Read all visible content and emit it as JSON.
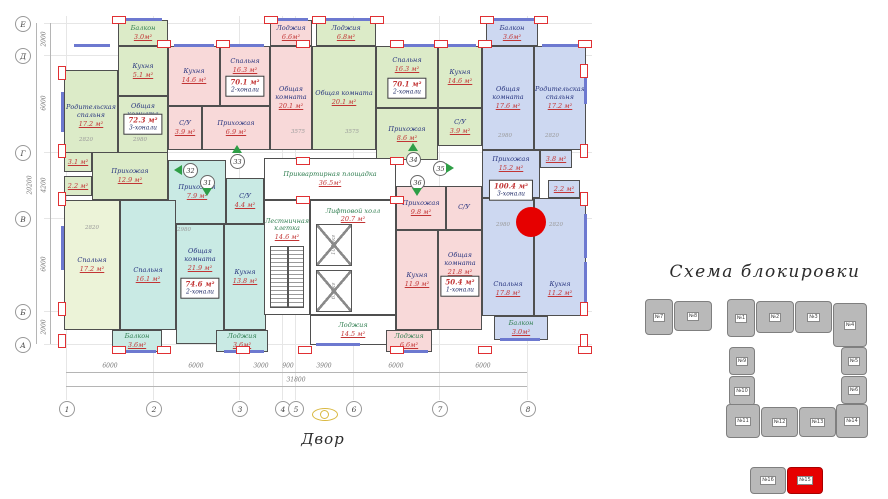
{
  "palette": {
    "green": "#dcebc8",
    "pale": "#ecf3d8",
    "pink": "#f8d9d9",
    "teal": "#c9eae4",
    "blue": "#cdd8f1",
    "white": "#ffffff"
  },
  "plan": {
    "rooms": [
      {
        "n": "Родительская спальня",
        "a": "17.2 м²",
        "x": 64,
        "y": 70,
        "w": 54,
        "h": 92,
        "c": "green"
      },
      {
        "n": "Балкон",
        "a": "3.0м²",
        "x": 118,
        "y": 20,
        "w": 50,
        "h": 26,
        "c": "green",
        "tc": "green"
      },
      {
        "n": "Кухня",
        "a": "5.1 м²",
        "x": 118,
        "y": 46,
        "w": 50,
        "h": 50,
        "c": "green"
      },
      {
        "n": "Общая комната",
        "a": "17.6 м²",
        "x": 118,
        "y": 96,
        "w": 50,
        "h": 66,
        "c": "green",
        "dy": -14
      },
      {
        "n": "",
        "a": "3.1 м²",
        "x": 64,
        "y": 152,
        "w": 28,
        "h": 20,
        "c": "green"
      },
      {
        "n": "Прихожая",
        "a": "12.9 м²",
        "x": 92,
        "y": 152,
        "w": 76,
        "h": 48,
        "c": "green"
      },
      {
        "n": "",
        "a": "2.2 м²",
        "x": 64,
        "y": 176,
        "w": 28,
        "h": 20,
        "c": "green"
      },
      {
        "n": "Спальня",
        "a": "17.2 м²",
        "x": 64,
        "y": 200,
        "w": 56,
        "h": 130,
        "c": "pale"
      },
      {
        "n": "Кухня",
        "a": "14.6 м²",
        "x": 168,
        "y": 46,
        "w": 52,
        "h": 60,
        "c": "pink"
      },
      {
        "n": "Спальня",
        "a": "16.3 м²",
        "x": 220,
        "y": 46,
        "w": 50,
        "h": 60,
        "c": "pink",
        "dy": -10
      },
      {
        "n": "Общая комната",
        "a": "20.1 м²",
        "x": 270,
        "y": 46,
        "w": 42,
        "h": 104,
        "c": "pink"
      },
      {
        "n": "Лоджия",
        "a": "6.6м²",
        "x": 270,
        "y": 20,
        "w": 42,
        "h": 26,
        "c": "pink"
      },
      {
        "n": "С/У",
        "a": "3.9 м²",
        "x": 168,
        "y": 106,
        "w": 34,
        "h": 44,
        "c": "pink"
      },
      {
        "n": "Прихожая",
        "a": "6.9 м²",
        "x": 202,
        "y": 106,
        "w": 68,
        "h": 44,
        "c": "pink"
      },
      {
        "n": "Лоджия",
        "a": "6.8м²",
        "x": 316,
        "y": 20,
        "w": 60,
        "h": 26,
        "c": "green"
      },
      {
        "n": "Общая комната",
        "a": "20.1 м²",
        "x": 312,
        "y": 46,
        "w": 64,
        "h": 104,
        "c": "green"
      },
      {
        "n": "Спальня",
        "a": "16.3 м²",
        "x": 376,
        "y": 46,
        "w": 62,
        "h": 62,
        "c": "green",
        "dy": -12
      },
      {
        "n": "Кухня",
        "a": "14.6 м²",
        "x": 438,
        "y": 46,
        "w": 44,
        "h": 62,
        "c": "green"
      },
      {
        "n": "С/У",
        "a": "3.9 м²",
        "x": 438,
        "y": 108,
        "w": 44,
        "h": 38,
        "c": "green"
      },
      {
        "n": "Прихожая",
        "a": "8.6 м²",
        "x": 376,
        "y": 108,
        "w": 62,
        "h": 52,
        "c": "green"
      },
      {
        "n": "Балкон",
        "a": "3.6м²",
        "x": 486,
        "y": 20,
        "w": 52,
        "h": 26,
        "c": "blue"
      },
      {
        "n": "Общая комната",
        "a": "17.6 м²",
        "x": 482,
        "y": 46,
        "w": 52,
        "h": 104,
        "c": "blue"
      },
      {
        "n": "Родительская спальня",
        "a": "17.2 м²",
        "x": 534,
        "y": 46,
        "w": 52,
        "h": 104,
        "c": "blue"
      },
      {
        "n": "",
        "a": "3.8 м²",
        "x": 540,
        "y": 150,
        "w": 32,
        "h": 18,
        "c": "blue"
      },
      {
        "n": "Прихожая",
        "a": "15.2 м²",
        "x": 482,
        "y": 150,
        "w": 58,
        "h": 48,
        "c": "blue",
        "dy": -10
      },
      {
        "n": "",
        "a": "2.2 м²",
        "x": 548,
        "y": 180,
        "w": 32,
        "h": 18,
        "c": "blue"
      },
      {
        "n": "Спальня",
        "a": "17.8 м²",
        "x": 482,
        "y": 198,
        "w": 52,
        "h": 118,
        "c": "blue",
        "dy": 32
      },
      {
        "n": "Кухня",
        "a": "11.2 м²",
        "x": 534,
        "y": 198,
        "w": 52,
        "h": 118,
        "c": "blue",
        "dy": 32
      },
      {
        "n": "Балкон",
        "a": "3.0м²",
        "x": 494,
        "y": 316,
        "w": 54,
        "h": 24,
        "c": "blue",
        "tc": "green"
      },
      {
        "n": "Прихожая",
        "a": "7.9 м²",
        "x": 168,
        "y": 160,
        "w": 58,
        "h": 64,
        "c": "teal"
      },
      {
        "n": "С/У",
        "a": "4.4 м²",
        "x": 226,
        "y": 178,
        "w": 38,
        "h": 46,
        "c": "teal"
      },
      {
        "n": "Спальня",
        "a": "16.1 м²",
        "x": 120,
        "y": 200,
        "w": 56,
        "h": 130,
        "c": "teal",
        "dy": 10
      },
      {
        "n": "Общая комната",
        "a": "21.9 м²",
        "x": 176,
        "y": 224,
        "w": 48,
        "h": 120,
        "c": "teal",
        "dy": -24
      },
      {
        "n": "Кухня",
        "a": "13.8 м²",
        "x": 224,
        "y": 224,
        "w": 42,
        "h": 106,
        "c": "teal"
      },
      {
        "n": "Балкон",
        "a": "3.6м²",
        "x": 112,
        "y": 330,
        "w": 50,
        "h": 22,
        "c": "teal",
        "tc": "green"
      },
      {
        "n": "Лоджия",
        "a": "3.6м²",
        "x": 216,
        "y": 330,
        "w": 52,
        "h": 22,
        "c": "teal",
        "tc": "green"
      },
      {
        "n": "Приквартирная площадка",
        "a": "36.5м²",
        "x": 264,
        "y": 158,
        "w": 132,
        "h": 42,
        "c": "white",
        "tc": "green"
      },
      {
        "n": "Лестничная клетка",
        "a": "14.6 м²",
        "x": 264,
        "y": 200,
        "w": 46,
        "h": 115,
        "c": "white",
        "tc": "green",
        "dy": -28
      },
      {
        "n": "Лифтовой холл",
        "a": "20.7 м²",
        "x": 310,
        "y": 200,
        "w": 86,
        "h": 115,
        "c": "white",
        "tc": "green",
        "dy": -42
      },
      {
        "n": "Лоджия",
        "a": "14.5 м²",
        "x": 310,
        "y": 315,
        "w": 86,
        "h": 30,
        "c": "white",
        "tc": "green"
      },
      {
        "n": "Прихожая",
        "a": "9.8 м²",
        "x": 396,
        "y": 186,
        "w": 50,
        "h": 44,
        "c": "pink"
      },
      {
        "n": "С/У",
        "a": "",
        "x": 446,
        "y": 186,
        "w": 36,
        "h": 44,
        "c": "pink"
      },
      {
        "n": "Кухня",
        "a": "11.9 м²",
        "x": 396,
        "y": 230,
        "w": 42,
        "h": 100,
        "c": "pink"
      },
      {
        "n": "Общая комната",
        "a": "21.8 м²",
        "x": 438,
        "y": 230,
        "w": 44,
        "h": 100,
        "c": "pink",
        "dy": -16
      },
      {
        "n": "Лоджия",
        "a": "6.6м²",
        "x": 386,
        "y": 330,
        "w": 46,
        "h": 22,
        "c": "pink",
        "tc": "green"
      }
    ],
    "units": [
      {
        "area": "72.3 м²",
        "rooms": "3-хонали",
        "x": 143,
        "y": 124
      },
      {
        "area": "70.1 м²",
        "rooms": "2-хонали",
        "x": 245,
        "y": 86
      },
      {
        "area": "70.1 м²",
        "rooms": "2-хонали",
        "x": 407,
        "y": 88
      },
      {
        "area": "100.4 м²",
        "rooms": "3-хонали",
        "x": 511,
        "y": 190
      },
      {
        "area": "74.6 м²",
        "rooms": "2-хонали",
        "x": 200,
        "y": 288
      },
      {
        "area": "50.4 м²",
        "rooms": "1-хонали",
        "x": 460,
        "y": 286
      }
    ],
    "markers": [
      {
        "num": "32",
        "x": 189,
        "y": 169,
        "dir": "left"
      },
      {
        "num": "31",
        "x": 206,
        "y": 181,
        "dir": "down"
      },
      {
        "num": "33",
        "x": 236,
        "y": 160,
        "dir": "up"
      },
      {
        "num": "34",
        "x": 412,
        "y": 158,
        "dir": "up"
      },
      {
        "num": "35",
        "x": 439,
        "y": 167,
        "dir": "right"
      },
      {
        "num": "36",
        "x": 416,
        "y": 181,
        "dir": "down"
      }
    ],
    "red_dot": {
      "x": 531,
      "y": 222
    },
    "lifts": {
      "cap1": "1000кг",
      "cap2": "630кг"
    },
    "windows": [
      {
        "x": 126,
        "y": 18,
        "w": 36,
        "h": 3
      },
      {
        "x": 278,
        "y": 18,
        "w": 30,
        "h": 3
      },
      {
        "x": 322,
        "y": 18,
        "w": 50,
        "h": 3
      },
      {
        "x": 492,
        "y": 18,
        "w": 42,
        "h": 3
      },
      {
        "x": 74,
        "y": 44,
        "w": 36,
        "h": 3
      },
      {
        "x": 174,
        "y": 44,
        "w": 40,
        "h": 3
      },
      {
        "x": 224,
        "y": 44,
        "w": 40,
        "h": 3
      },
      {
        "x": 398,
        "y": 44,
        "w": 36,
        "h": 3
      },
      {
        "x": 446,
        "y": 44,
        "w": 30,
        "h": 3
      },
      {
        "x": 542,
        "y": 44,
        "w": 38,
        "h": 3
      },
      {
        "x": 120,
        "y": 350,
        "w": 36,
        "h": 3
      },
      {
        "x": 224,
        "y": 350,
        "w": 40,
        "h": 3
      },
      {
        "x": 316,
        "y": 343,
        "w": 44,
        "h": 3
      },
      {
        "x": 392,
        "y": 350,
        "w": 36,
        "h": 3
      },
      {
        "x": 500,
        "y": 338,
        "w": 40,
        "h": 3
      },
      {
        "x": 61,
        "y": 92,
        "w": 3,
        "h": 40
      },
      {
        "x": 61,
        "y": 226,
        "w": 3,
        "h": 44
      },
      {
        "x": 584,
        "y": 64,
        "w": 3,
        "h": 40
      },
      {
        "x": 584,
        "y": 214,
        "w": 3,
        "h": 44
      },
      {
        "x": 584,
        "y": 262,
        "w": 3,
        "h": 40
      }
    ],
    "columns": [
      {
        "x": 112,
        "y": 16,
        "w": 14,
        "h": 8
      },
      {
        "x": 264,
        "y": 16,
        "w": 14,
        "h": 8
      },
      {
        "x": 312,
        "y": 16,
        "w": 14,
        "h": 8
      },
      {
        "x": 370,
        "y": 16,
        "w": 14,
        "h": 8
      },
      {
        "x": 480,
        "y": 16,
        "w": 14,
        "h": 8
      },
      {
        "x": 534,
        "y": 16,
        "w": 14,
        "h": 8
      },
      {
        "x": 157,
        "y": 40,
        "w": 14,
        "h": 8
      },
      {
        "x": 216,
        "y": 40,
        "w": 14,
        "h": 8
      },
      {
        "x": 296,
        "y": 40,
        "w": 14,
        "h": 8
      },
      {
        "x": 390,
        "y": 40,
        "w": 14,
        "h": 8
      },
      {
        "x": 434,
        "y": 40,
        "w": 14,
        "h": 8
      },
      {
        "x": 478,
        "y": 40,
        "w": 14,
        "h": 8
      },
      {
        "x": 578,
        "y": 40,
        "w": 14,
        "h": 8
      },
      {
        "x": 58,
        "y": 66,
        "w": 8,
        "h": 14
      },
      {
        "x": 58,
        "y": 144,
        "w": 8,
        "h": 14
      },
      {
        "x": 58,
        "y": 192,
        "w": 8,
        "h": 14
      },
      {
        "x": 58,
        "y": 302,
        "w": 8,
        "h": 14
      },
      {
        "x": 58,
        "y": 334,
        "w": 8,
        "h": 14
      },
      {
        "x": 580,
        "y": 64,
        "w": 8,
        "h": 14
      },
      {
        "x": 580,
        "y": 144,
        "w": 8,
        "h": 14
      },
      {
        "x": 580,
        "y": 192,
        "w": 8,
        "h": 14
      },
      {
        "x": 580,
        "y": 302,
        "w": 8,
        "h": 14
      },
      {
        "x": 580,
        "y": 334,
        "w": 8,
        "h": 14
      },
      {
        "x": 112,
        "y": 346,
        "w": 14,
        "h": 8
      },
      {
        "x": 157,
        "y": 346,
        "w": 14,
        "h": 8
      },
      {
        "x": 236,
        "y": 346,
        "w": 14,
        "h": 8
      },
      {
        "x": 298,
        "y": 346,
        "w": 14,
        "h": 8
      },
      {
        "x": 390,
        "y": 346,
        "w": 14,
        "h": 8
      },
      {
        "x": 478,
        "y": 346,
        "w": 14,
        "h": 8
      },
      {
        "x": 578,
        "y": 346,
        "w": 14,
        "h": 8
      },
      {
        "x": 296,
        "y": 157,
        "w": 14,
        "h": 8
      },
      {
        "x": 390,
        "y": 157,
        "w": 14,
        "h": 8
      },
      {
        "x": 296,
        "y": 196,
        "w": 14,
        "h": 8
      },
      {
        "x": 390,
        "y": 196,
        "w": 14,
        "h": 8
      }
    ],
    "inner_dims": [
      {
        "t": "2820",
        "x": 86,
        "y": 140
      },
      {
        "t": "2980",
        "x": 140,
        "y": 140
      },
      {
        "t": "3575",
        "x": 298,
        "y": 132
      },
      {
        "t": "3575",
        "x": 352,
        "y": 132
      },
      {
        "t": "2980",
        "x": 505,
        "y": 136
      },
      {
        "t": "2820",
        "x": 552,
        "y": 136
      },
      {
        "t": "2980",
        "x": 184,
        "y": 230
      },
      {
        "t": "2820",
        "x": 92,
        "y": 228
      },
      {
        "t": "2980",
        "x": 503,
        "y": 225
      },
      {
        "t": "2820",
        "x": 556,
        "y": 225
      }
    ]
  },
  "axes": {
    "letters": [
      {
        "l": "Е",
        "y": 23
      },
      {
        "l": "Д",
        "y": 55
      },
      {
        "l": "Г",
        "y": 152
      },
      {
        "l": "В",
        "y": 218
      },
      {
        "l": "Б",
        "y": 311
      },
      {
        "l": "А",
        "y": 344
      }
    ],
    "numbers": [
      {
        "l": "1",
        "x": 66
      },
      {
        "l": "2",
        "x": 153
      },
      {
        "l": "3",
        "x": 239
      },
      {
        "l": "4",
        "x": 282
      },
      {
        "l": "5",
        "x": 295
      },
      {
        "l": "6",
        "x": 353
      },
      {
        "l": "7",
        "x": 439
      },
      {
        "l": "8",
        "x": 527
      }
    ]
  },
  "dims": {
    "left": [
      {
        "t": "2000",
        "y": 39
      },
      {
        "t": "6000",
        "y": 103
      },
      {
        "t": "4200",
        "y": 185
      },
      {
        "t": "6000",
        "y": 264
      },
      {
        "t": "2000",
        "y": 327
      }
    ],
    "left_total": "20200",
    "bottom": [
      {
        "t": "6000",
        "x": 110
      },
      {
        "t": "6000",
        "x": 196
      },
      {
        "t": "3000",
        "x": 261
      },
      {
        "t": "900",
        "x": 288
      },
      {
        "t": "3900",
        "x": 324
      },
      {
        "t": "6000",
        "x": 396
      },
      {
        "t": "6000",
        "x": 483
      }
    ],
    "bottom_total": "31800"
  },
  "courtyard": {
    "label": "Двор"
  },
  "minimap": {
    "title": "Схема блокировки",
    "blocks": [
      {
        "x": 645,
        "y": 299,
        "w": 28,
        "h": 36,
        "label": "№7",
        "red": false
      },
      {
        "x": 674,
        "y": 301,
        "w": 38,
        "h": 30,
        "label": "№8",
        "red": false
      },
      {
        "x": 727,
        "y": 299,
        "w": 28,
        "h": 38,
        "label": "№1",
        "red": false
      },
      {
        "x": 756,
        "y": 301,
        "w": 38,
        "h": 32,
        "label": "№2",
        "red": false
      },
      {
        "x": 795,
        "y": 301,
        "w": 37,
        "h": 32,
        "label": "№3",
        "red": false
      },
      {
        "x": 833,
        "y": 303,
        "w": 34,
        "h": 44,
        "label": "№4",
        "red": false
      },
      {
        "x": 841,
        "y": 347,
        "w": 26,
        "h": 28,
        "label": "№5",
        "red": false
      },
      {
        "x": 841,
        "y": 376,
        "w": 26,
        "h": 28,
        "label": "№6",
        "red": false
      },
      {
        "x": 729,
        "y": 347,
        "w": 26,
        "h": 28,
        "label": "№9",
        "red": false
      },
      {
        "x": 729,
        "y": 376,
        "w": 26,
        "h": 30,
        "label": "№10",
        "red": false
      },
      {
        "x": 726,
        "y": 404,
        "w": 34,
        "h": 34,
        "label": "№11",
        "red": false
      },
      {
        "x": 761,
        "y": 407,
        "w": 37,
        "h": 30,
        "label": "№12",
        "red": false
      },
      {
        "x": 799,
        "y": 407,
        "w": 37,
        "h": 30,
        "label": "№13",
        "red": false
      },
      {
        "x": 836,
        "y": 404,
        "w": 32,
        "h": 34,
        "label": "№14",
        "red": false
      },
      {
        "x": 750,
        "y": 467,
        "w": 36,
        "h": 27,
        "label": "№16",
        "red": false
      },
      {
        "x": 787,
        "y": 467,
        "w": 36,
        "h": 27,
        "label": "№15",
        "red": true
      }
    ]
  }
}
